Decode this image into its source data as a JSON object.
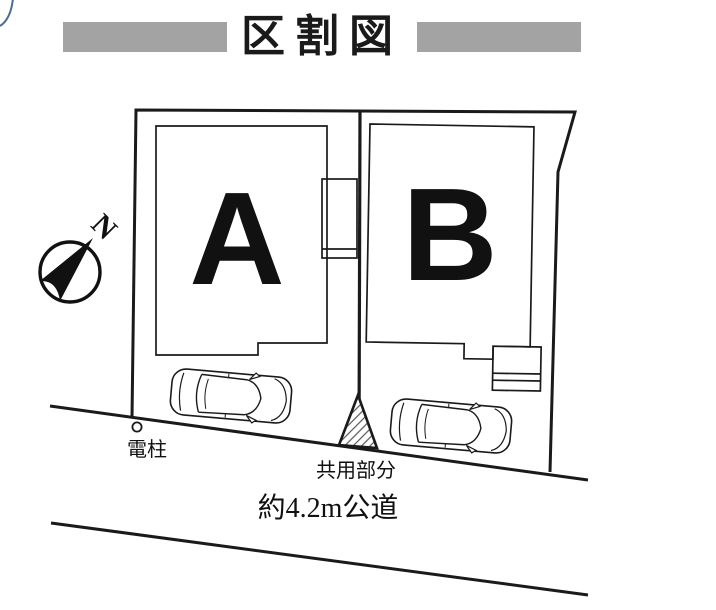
{
  "title": {
    "text": "区割図"
  },
  "compass": {
    "label": "N"
  },
  "plots": [
    {
      "label": "A"
    },
    {
      "label": "B"
    }
  ],
  "labels": {
    "utility_pole": "電柱",
    "shared_area": "共用部分",
    "road": "約4.2m公道"
  },
  "colors": {
    "ink": "#1a1a1a",
    "title_bar_gray": "#a3a3a3",
    "hatch_gray": "#555555",
    "corner_accent_blue": "#4a6d94",
    "background": "#ffffff"
  }
}
